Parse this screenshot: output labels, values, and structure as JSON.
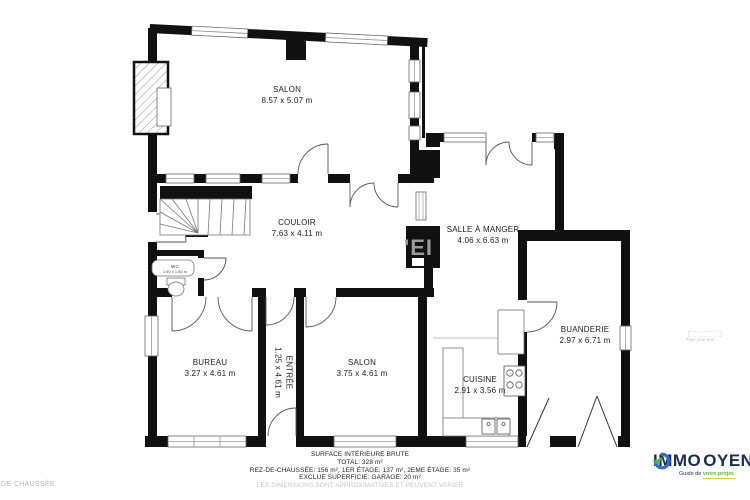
{
  "rooms": {
    "salon_top": {
      "name": "SALON",
      "dims": "8.57 x 5.07 m"
    },
    "couloir": {
      "name": "COULOIR",
      "dims": "7.63 x 4.11 m"
    },
    "salle_a_manger": {
      "name": "SALLE À MANGER",
      "dims": "4.06 x 6.63 m"
    },
    "buanderie": {
      "name": "BUANDERIE",
      "dims": "2.97 x 6.71 m"
    },
    "bureau": {
      "name": "BUREAU",
      "dims": "3.27 x 4.61 m"
    },
    "entree": {
      "name": "ENTRÉE",
      "dims": "1.25 x 4.61 m"
    },
    "salon_bottom": {
      "name": "SALON",
      "dims": "3.75 x 4.61 m"
    },
    "cuisine": {
      "name": "CUISINE",
      "dims": "2.91 x 3.56 m"
    },
    "wc": {
      "name": "WC",
      "dims": "1.60 x 1.50 m"
    }
  },
  "footer": {
    "title": "SURFACE INTÉRIEURE BRUTE",
    "total": "TOTAL: 328 m²",
    "floors": "REZ-DE-CHAUSSÉE: 156 m², 1ER ÉTAGE: 137 m², 2EME ÉTAGE: 35 m²",
    "excluded": "EXCLUE SUPERFICIE: GARAGE: 20 m²",
    "disclaimer": "LES DIMENSIONS SONT APPROXIMATIVES ET PEUVENT VARIER"
  },
  "side_notes": {
    "floor_note": "DE-CHAUSSÉE",
    "placeholder": "Type your text"
  },
  "watermark": {
    "chimney_text": "'EI"
  },
  "logo": {
    "brand_left": "IMMO",
    "brand_right": "OYEN",
    "tagline_left": "Guide de ",
    "tagline_right": "votre projet.",
    "colors": {
      "navy": "#1c2a5e",
      "blue": "#2b6fd0",
      "green": "#57b847",
      "yellow": "#e8c832"
    }
  }
}
